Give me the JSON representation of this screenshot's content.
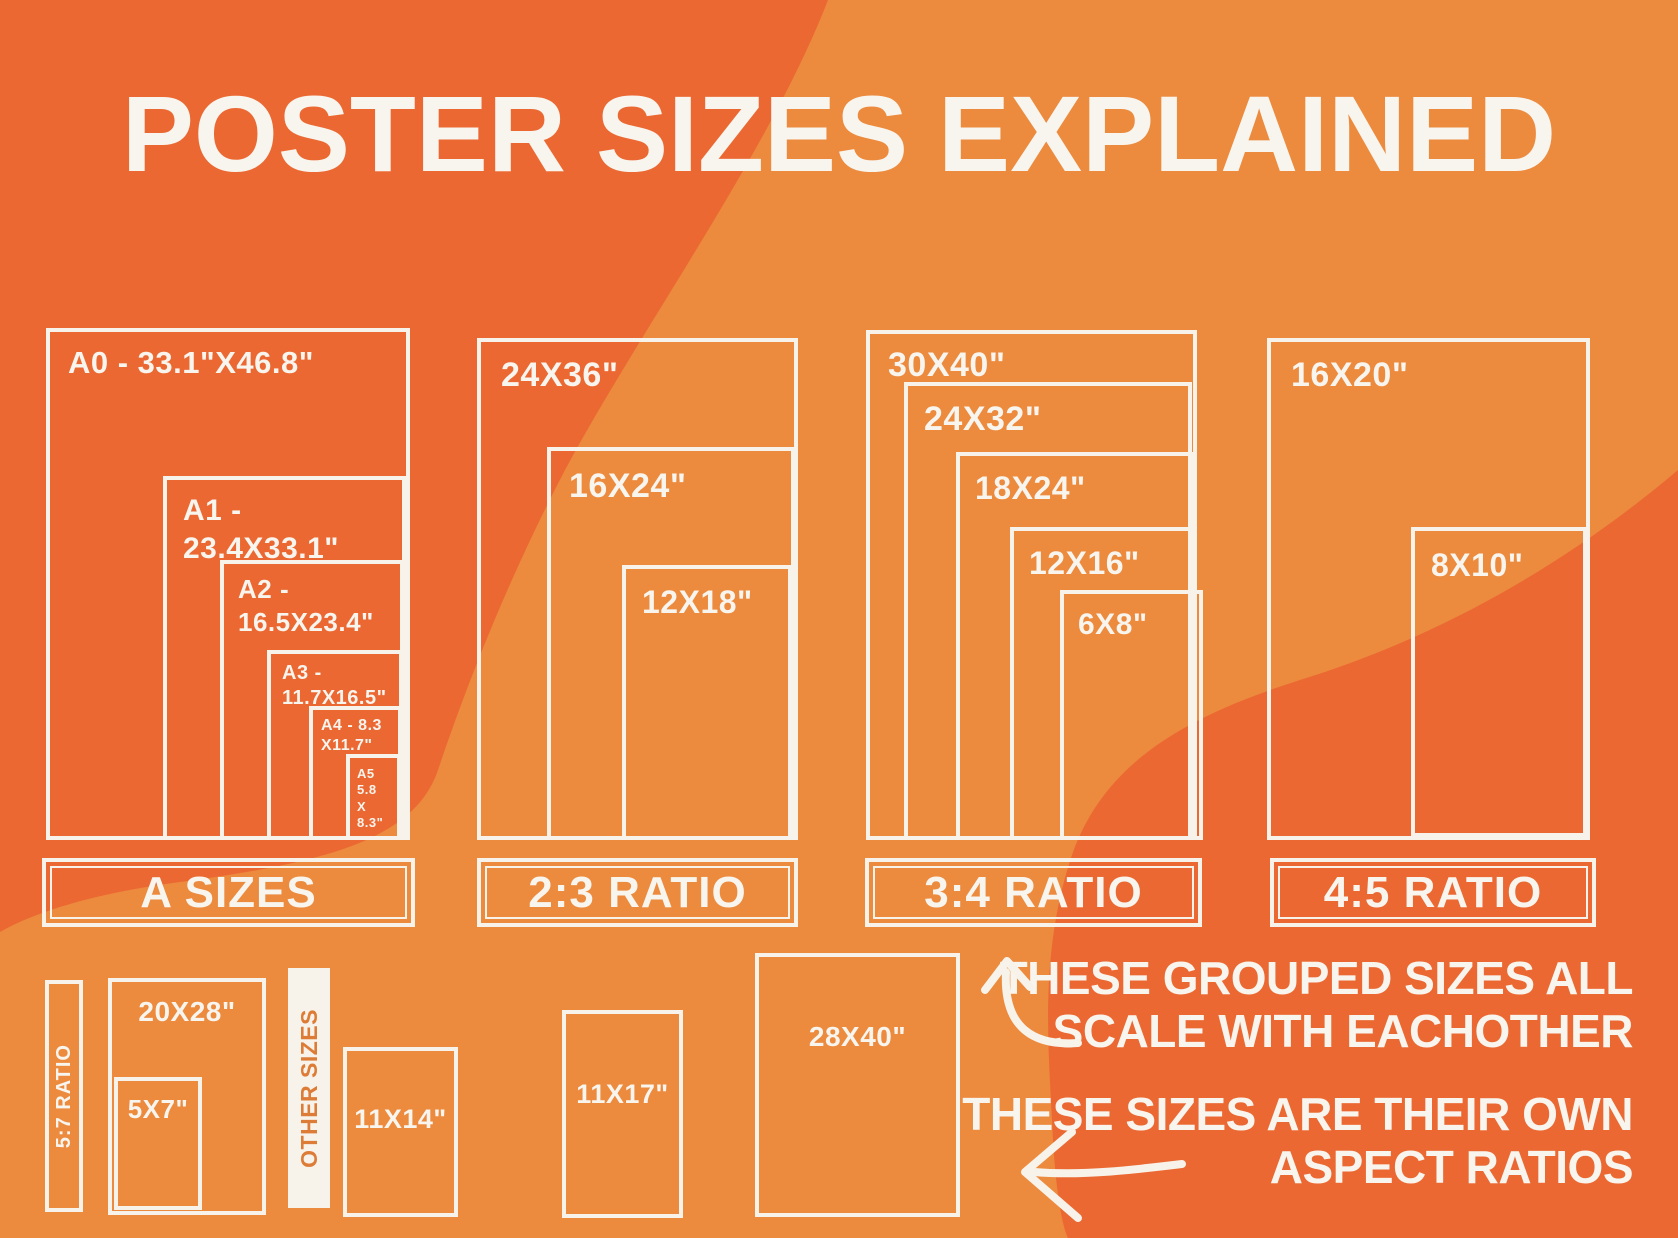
{
  "title": "POSTER SIZES EXPLAINED",
  "groups": [
    {
      "label": "A SIZES",
      "boxes": [
        "A0 - 33.1\"X46.8\"",
        "A1 - 23.4X33.1\"",
        "A2 - 16.5X23.4\"",
        "A3 - 11.7X16.5\"",
        "A4 - 8.3\nX11.7\"",
        "A5\n5.8\nX\n8.3\""
      ]
    },
    {
      "label": "2:3 RATIO",
      "boxes": [
        "24X36\"",
        "16X24\"",
        "12X18\""
      ]
    },
    {
      "label": "3:4 RATIO",
      "boxes": [
        "30X40\"",
        "24X32\"",
        "18X24\"",
        "12X16\"",
        "6X8\""
      ]
    },
    {
      "label": "4:5 RATIO",
      "boxes": [
        "16X20\"",
        "8X10\""
      ]
    }
  ],
  "other_sizes": {
    "ratio_sidebar_label": "5:7 RATIO",
    "divider_label": "OTHER SIZES",
    "boxes": [
      "20X28\"",
      "5X7\"",
      "11X14\"",
      "11X17\"",
      "28X40\""
    ]
  },
  "annotations": {
    "grouped_note": "THESE GROUPED SIZES ALL\nSCALE WITH EACHOTHER",
    "own_note": "THESE SIZES ARE THEIR OWN\nASPECT RATIOS"
  },
  "colors": {
    "background_light": "#EC8A3E",
    "background_dark": "#EB6832",
    "line_cream": "#F7F3EA",
    "divider_text_orange": "#DD7C37"
  }
}
